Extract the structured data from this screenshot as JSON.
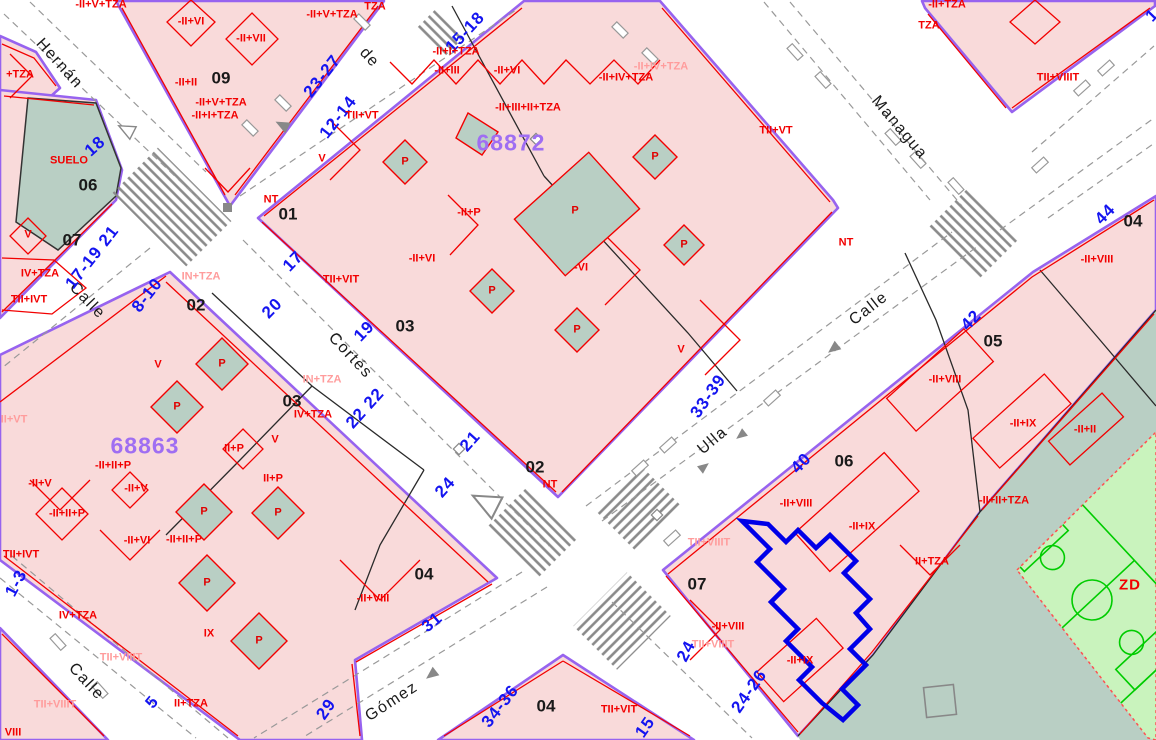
{
  "map": {
    "colors": {
      "block_fill": "#f9dada",
      "border_purple": "#9763ef",
      "parcel_line_red": "#f20000",
      "sage_green": "#b9cfc4",
      "field_green": "#c9f3bd",
      "field_line_green": "#00cc00",
      "street_number_blue": "#1414f0",
      "block_code_purple": "#9f6ef2",
      "selection_blue": "#0000e8",
      "road_marking_gray": "#8a8a8a"
    },
    "block_codes": [
      {
        "text": "68872",
        "x": 511,
        "y": 143
      },
      {
        "text": "68863",
        "x": 145,
        "y": 446
      }
    ],
    "street_names": [
      {
        "text": "Hernán",
        "x": 59,
        "y": 64,
        "rot": 48
      },
      {
        "text": "de",
        "x": 369,
        "y": 58,
        "rot": 48
      },
      {
        "text": "Calle",
        "x": 87,
        "y": 301,
        "rot": 46
      },
      {
        "text": "Cortés",
        "x": 350,
        "y": 356,
        "rot": 47
      },
      {
        "text": "Managua",
        "x": 899,
        "y": 128,
        "rot": 50
      },
      {
        "text": "Calle",
        "x": 869,
        "y": 309,
        "rot": -38
      },
      {
        "text": "Ulla",
        "x": 713,
        "y": 441,
        "rot": -40
      },
      {
        "text": "Gómez",
        "x": 392,
        "y": 702,
        "rot": -33
      },
      {
        "text": "Calle",
        "x": 86,
        "y": 682,
        "rot": 47
      }
    ],
    "street_numbers": [
      {
        "text": "18",
        "x": 95,
        "y": 146,
        "rot": -42
      },
      {
        "text": "17-19 21",
        "x": 92,
        "y": 257,
        "rot": -52
      },
      {
        "text": "8-10",
        "x": 147,
        "y": 295,
        "rot": -52
      },
      {
        "text": "23-27",
        "x": 322,
        "y": 76,
        "rot": -52
      },
      {
        "text": "12-14",
        "x": 338,
        "y": 117,
        "rot": -52
      },
      {
        "text": "15-18",
        "x": 465,
        "y": 32,
        "rot": -47
      },
      {
        "text": "17",
        "x": 293,
        "y": 261,
        "rot": -46
      },
      {
        "text": "20",
        "x": 272,
        "y": 308,
        "rot": -46
      },
      {
        "text": "19",
        "x": 364,
        "y": 331,
        "rot": -46
      },
      {
        "text": "22 22",
        "x": 365,
        "y": 408,
        "rot": -48
      },
      {
        "text": "21",
        "x": 470,
        "y": 441,
        "rot": -48
      },
      {
        "text": "24",
        "x": 445,
        "y": 487,
        "rot": -48
      },
      {
        "text": "31",
        "x": 432,
        "y": 622,
        "rot": -40
      },
      {
        "text": "29",
        "x": 326,
        "y": 709,
        "rot": -55
      },
      {
        "text": "34-36",
        "x": 500,
        "y": 706,
        "rot": -52
      },
      {
        "text": "1-3",
        "x": 16,
        "y": 583,
        "rot": -62
      },
      {
        "text": "5",
        "x": 152,
        "y": 702,
        "rot": -50
      },
      {
        "text": "33-39",
        "x": 708,
        "y": 396,
        "rot": -55
      },
      {
        "text": "40",
        "x": 801,
        "y": 463,
        "rot": -46
      },
      {
        "text": "42",
        "x": 971,
        "y": 320,
        "rot": -46
      },
      {
        "text": "44",
        "x": 1105,
        "y": 214,
        "rot": -46
      },
      {
        "text": "24",
        "x": 686,
        "y": 651,
        "rot": -62
      },
      {
        "text": "24-26",
        "x": 749,
        "y": 691,
        "rot": -55
      },
      {
        "text": "15",
        "x": 645,
        "y": 727,
        "rot": -55
      },
      {
        "text": "1",
        "x": 1152,
        "y": 15,
        "rot": -46
      }
    ],
    "lot_numbers": [
      {
        "text": "09",
        "x": 221,
        "y": 78
      },
      {
        "text": "06",
        "x": 88,
        "y": 185
      },
      {
        "text": "07",
        "x": 72,
        "y": 240
      },
      {
        "text": "02",
        "x": 196,
        "y": 305
      },
      {
        "text": "03",
        "x": 292,
        "y": 401
      },
      {
        "text": "01",
        "x": 288,
        "y": 214
      },
      {
        "text": "03",
        "x": 405,
        "y": 326
      },
      {
        "text": "02",
        "x": 535,
        "y": 467
      },
      {
        "text": "04",
        "x": 424,
        "y": 574
      },
      {
        "text": "04",
        "x": 546,
        "y": 706
      },
      {
        "text": "05",
        "x": 993,
        "y": 341
      },
      {
        "text": "06",
        "x": 844,
        "y": 461
      },
      {
        "text": "07",
        "x": 697,
        "y": 584
      },
      {
        "text": "04",
        "x": 1133,
        "y": 221
      }
    ],
    "parcel_labels": [
      {
        "text": "-II+VI",
        "x": 191,
        "y": 22
      },
      {
        "text": "-II+VII",
        "x": 251,
        "y": 39
      },
      {
        "text": "-II+II",
        "x": 186,
        "y": 83
      },
      {
        "text": "-II+V+TZA",
        "x": 221,
        "y": 103
      },
      {
        "text": "-II+I+TZA",
        "x": 215,
        "y": 116
      },
      {
        "text": "-II+V+TZA",
        "x": 101,
        "y": 5
      },
      {
        "text": "-II+V+TZA",
        "x": 332,
        "y": 15
      },
      {
        "text": "+TZA",
        "x": 20,
        "y": 75
      },
      {
        "text": "SUELO",
        "x": 69,
        "y": 161
      },
      {
        "text": "V",
        "x": 28,
        "y": 235
      },
      {
        "text": "IV+TZA",
        "x": 40,
        "y": 274
      },
      {
        "text": "TII+IVT",
        "x": 29,
        "y": 300
      },
      {
        "text": "NT",
        "x": 271,
        "y": 200
      },
      {
        "text": "TII+VT",
        "x": 362,
        "y": 116
      },
      {
        "text": "V",
        "x": 322,
        "y": 159
      },
      {
        "text": "TII+VIT",
        "x": 341,
        "y": 280
      },
      {
        "text": "-II+P",
        "x": 469,
        "y": 213
      },
      {
        "text": "-II+VI",
        "x": 422,
        "y": 259
      },
      {
        "text": "-VI",
        "x": 581,
        "y": 268
      },
      {
        "text": "-II+III",
        "x": 447,
        "y": 71
      },
      {
        "text": "-II+VI",
        "x": 507,
        "y": 71
      },
      {
        "text": "-II+I+TZA",
        "x": 456,
        "y": 52
      },
      {
        "text": "-II+III+II+TZA",
        "x": 528,
        "y": 108
      },
      {
        "text": "-II+IV+TZA",
        "x": 626,
        "y": 78
      },
      {
        "text": "-II+IV+TZA",
        "x": 661,
        "y": 67,
        "light": true
      },
      {
        "text": "TZA",
        "x": 375,
        "y": 7
      },
      {
        "text": "V",
        "x": 681,
        "y": 350
      },
      {
        "text": "TII+VT",
        "x": 776,
        "y": 131
      },
      {
        "text": "NT",
        "x": 550,
        "y": 485
      },
      {
        "text": "-II+TZA",
        "x": 947,
        "y": 5
      },
      {
        "text": "TZA",
        "x": 929,
        "y": 26
      },
      {
        "text": "TII+VIIIT",
        "x": 1058,
        "y": 78
      },
      {
        "text": "NT",
        "x": 846,
        "y": 243
      },
      {
        "text": "-II+VIII",
        "x": 1097,
        "y": 260
      },
      {
        "text": "-II+VIII",
        "x": 945,
        "y": 380
      },
      {
        "text": "-II+IX",
        "x": 1023,
        "y": 424
      },
      {
        "text": "-II+II",
        "x": 1085,
        "y": 430
      },
      {
        "text": "-II+II+TZA",
        "x": 1004,
        "y": 501
      },
      {
        "text": "-II+VIII",
        "x": 796,
        "y": 504
      },
      {
        "text": "-II+IX",
        "x": 862,
        "y": 527
      },
      {
        "text": "II+TZA",
        "x": 932,
        "y": 562
      },
      {
        "text": "TII+VIIIT",
        "x": 709,
        "y": 543,
        "light": true
      },
      {
        "text": "-II+VIII",
        "x": 728,
        "y": 627
      },
      {
        "text": "TII+VIIIT",
        "x": 713,
        "y": 645,
        "light": true
      },
      {
        "text": "-II+IX",
        "x": 800,
        "y": 661
      },
      {
        "text": "TII+VIT",
        "x": 619,
        "y": 710
      },
      {
        "text": "IN+TZA",
        "x": 201,
        "y": 277,
        "light": true
      },
      {
        "text": "V",
        "x": 158,
        "y": 365
      },
      {
        "text": "IN+TZA",
        "x": 322,
        "y": 380,
        "light": true
      },
      {
        "text": "IV+TZA",
        "x": 313,
        "y": 415
      },
      {
        "text": "V",
        "x": 275,
        "y": 440
      },
      {
        "text": "II+P",
        "x": 234,
        "y": 449
      },
      {
        "text": "II+P",
        "x": 273,
        "y": 479
      },
      {
        "text": "-II+II+P",
        "x": 113,
        "y": 466
      },
      {
        "text": "-II+V",
        "x": 40,
        "y": 484
      },
      {
        "text": "-II+V",
        "x": 136,
        "y": 489
      },
      {
        "text": "-II+II+P",
        "x": 67,
        "y": 514
      },
      {
        "text": "-II+VI",
        "x": 137,
        "y": 541
      },
      {
        "text": "-II+II+P",
        "x": 184,
        "y": 540
      },
      {
        "text": "IX",
        "x": 209,
        "y": 634
      },
      {
        "text": "IV+TZA",
        "x": 78,
        "y": 616
      },
      {
        "text": "TII+VIIIT",
        "x": 121,
        "y": 658,
        "light": true
      },
      {
        "text": "TII+VIIIT",
        "x": 55,
        "y": 705,
        "light": true
      },
      {
        "text": "II+TZA",
        "x": 191,
        "y": 704
      },
      {
        "text": "VIII",
        "x": 13,
        "y": 733
      },
      {
        "text": "-II+VIII",
        "x": 373,
        "y": 599
      },
      {
        "text": "II+VT",
        "x": 14,
        "y": 420,
        "light": true
      },
      {
        "text": "TII+IVT",
        "x": 21,
        "y": 555
      }
    ],
    "p_markers": [
      {
        "text": "P",
        "x": 405,
        "y": 162
      },
      {
        "text": "P",
        "x": 492,
        "y": 291
      },
      {
        "text": "P",
        "x": 577,
        "y": 330
      },
      {
        "text": "P",
        "x": 655,
        "y": 157
      },
      {
        "text": "P",
        "x": 684,
        "y": 245
      },
      {
        "text": "P",
        "x": 575,
        "y": 211
      },
      {
        "text": "P",
        "x": 222,
        "y": 364
      },
      {
        "text": "P",
        "x": 177,
        "y": 407
      },
      {
        "text": "P",
        "x": 204,
        "y": 512
      },
      {
        "text": "P",
        "x": 278,
        "y": 513
      },
      {
        "text": "P",
        "x": 207,
        "y": 583
      },
      {
        "text": "P",
        "x": 259,
        "y": 641
      }
    ],
    "zone_labels": [
      {
        "text": "ZD",
        "x": 1130,
        "y": 585
      }
    ]
  }
}
